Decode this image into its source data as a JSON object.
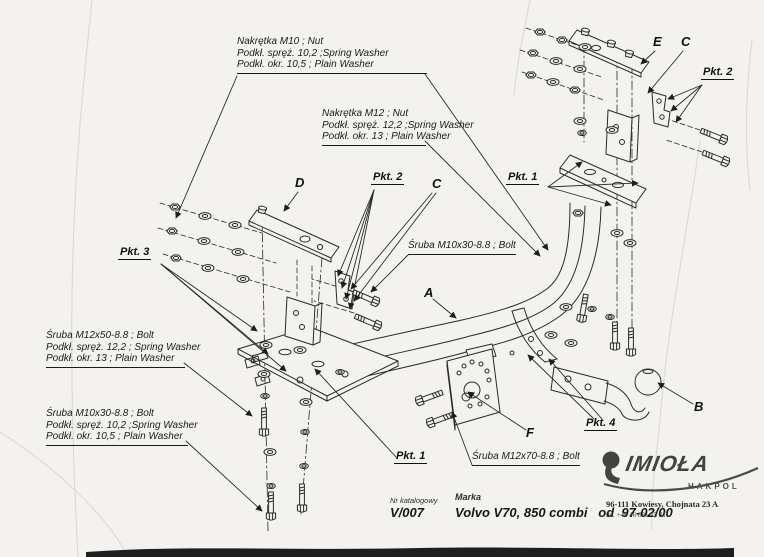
{
  "page": {
    "description": "Scanned exploded-view tow-bar assembly drawing",
    "colors": {
      "paper": "#f3f2ee",
      "ink": "#2a2a2a",
      "logo_gray": "#434343",
      "scan_edge": "#1e1e1e"
    }
  },
  "notes": {
    "nut_m10": {
      "l1": "Nakrętka M10 ; Nut",
      "l2": "Podkł. spręż. 10,2 ;Spring Washer",
      "l3": "Podkł. okr. 10,5 ; Plain Washer"
    },
    "nut_m12": {
      "l1": "Nakrętka M12 ; Nut",
      "l2": "Podkł. spręż. 12,2 ;Spring Washer",
      "l3": "Podkł. okr. 13 ; Plain Washer"
    },
    "bolt_m12x50": {
      "l1": "Śruba M12x50-8.8 ; Bolt",
      "l2": "Podkł. spręż. 12,2 ; Spring Washer",
      "l3": "Podkł. okr. 13 ; Plain Washer"
    },
    "bolt_m10x30_stack": {
      "l1": "Śruba M10x30-8.8 ; Bolt",
      "l2": "Podkł. spręż. 10,2 ;Spring Washer",
      "l3": "Podkł. okr. 10,5 ; Plain Washer"
    },
    "bolt_m10x30": "Śruba M10x30-8.8 ; Bolt",
    "bolt_m12x70": "Śruba M12x70-8.8 ; Bolt"
  },
  "parts": {
    "a": "A",
    "b": "B",
    "c": "C",
    "d": "D",
    "e": "E",
    "f": "F"
  },
  "points": {
    "p1": "Pkt. 1",
    "p2": "Pkt. 2",
    "p3": "Pkt. 3",
    "p4": "Pkt. 4"
  },
  "title_block": {
    "catalog_label": "Nr katalogowy",
    "catalog_number": "V/007",
    "brand_label": "Marka",
    "brand_value": "Volvo V70, 850 combi   od  97-02/00",
    "address_line1": "96-111 Kowiesy, Chojnata 23 A",
    "address_line2": "tel. +48 46 831 75 31"
  },
  "logo": {
    "name": "IMIOŁA",
    "sub": "HAKPOL"
  }
}
